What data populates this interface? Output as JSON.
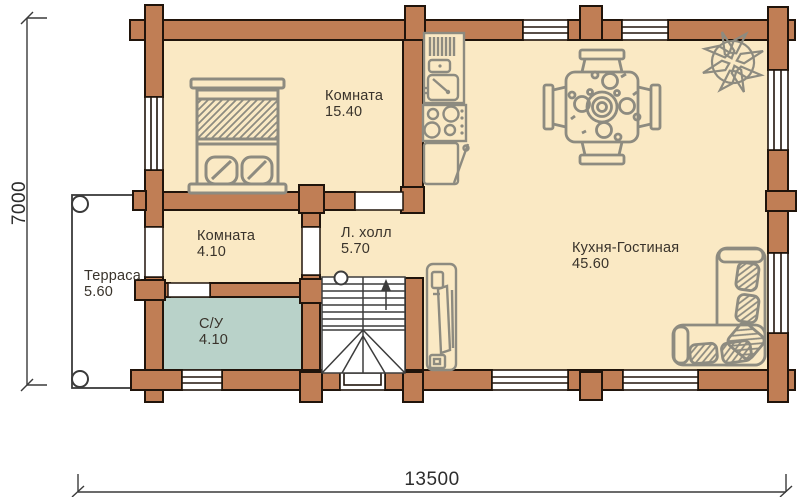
{
  "plan": {
    "type": "floor-plan",
    "rooms": [
      {
        "id": "bedroom",
        "name": "Комната",
        "area": "15.40"
      },
      {
        "id": "small-room",
        "name": "Комната",
        "area": "4.10"
      },
      {
        "id": "stair-hall",
        "name": "Л. холл",
        "area": "5.70"
      },
      {
        "id": "bathroom",
        "name": "С/У",
        "area": "4.10"
      },
      {
        "id": "kitchen-living",
        "name": "Кухня-Гостиная",
        "area": "45.60"
      },
      {
        "id": "terrace",
        "name": "Терраса",
        "area": "5.60"
      }
    ],
    "dimensions": {
      "width": "13500",
      "height": "7000"
    },
    "furniture_icons": [
      "double-bed-icon",
      "kitchen-sink-icon",
      "stove-icon",
      "kitchen-cabinet-icon",
      "dining-table-icon",
      "compass-rose-icon",
      "stairs-icon",
      "tv-stand-icon",
      "corner-sofa-icon",
      "terrace-post-icon"
    ],
    "colors": {
      "wall": "#c07e55",
      "wall_outline": "#20140b",
      "floor": "#fae9c4",
      "bathroom_floor": "#b9d2c9",
      "furniture": "#8d8b80",
      "text": "#39332b",
      "dimension": "#2d2d2d"
    }
  }
}
